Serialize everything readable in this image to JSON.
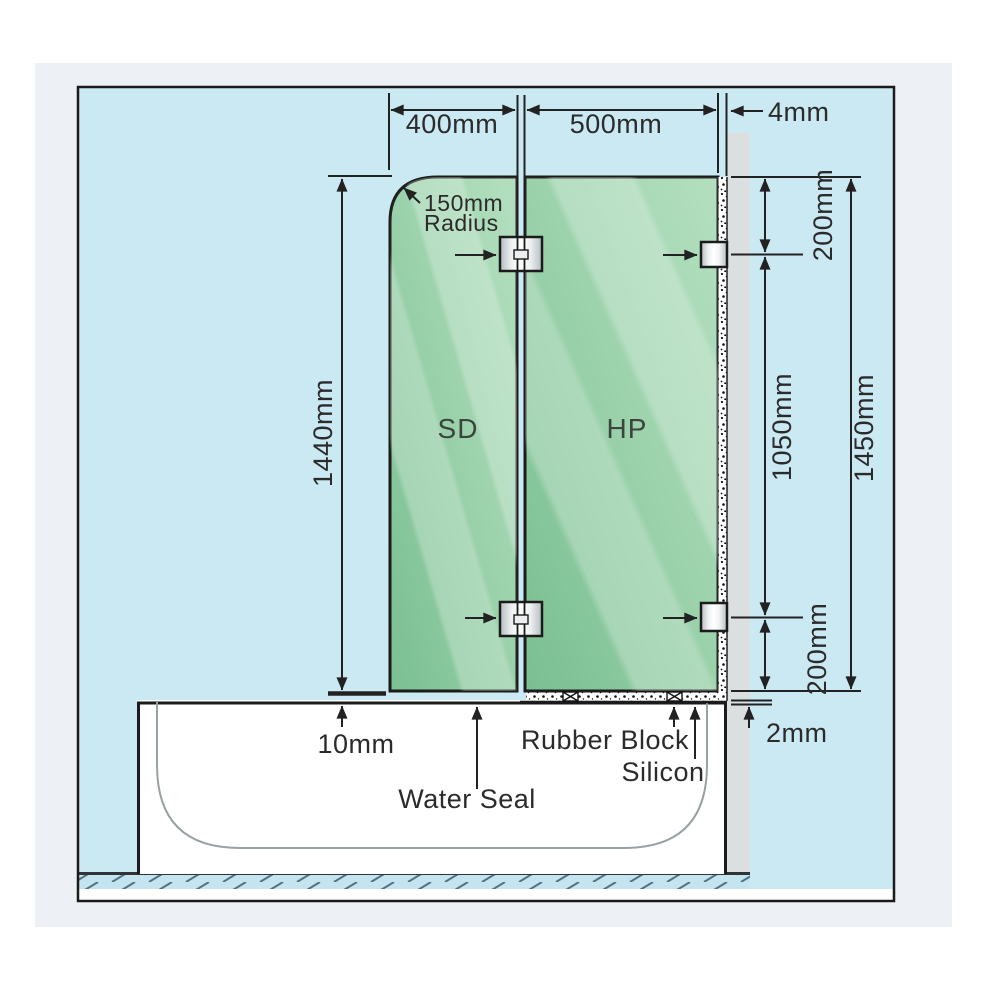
{
  "diagram": {
    "dims": {
      "sd_width": "400mm",
      "hp_width": "500mm",
      "wall_gap": "4mm",
      "radius_value": "150mm",
      "radius_word": "Radius",
      "sd_height": "1440mm",
      "top_bracket_offset": "200mm",
      "bracket_span": "1050mm",
      "hp_height": "1450mm",
      "bottom_bracket_offset": "200mm",
      "tub_gap": "2mm",
      "sd_bottom_gap": "10mm"
    },
    "labels": {
      "sd_panel": "SD",
      "hp_panel": "HP",
      "water_seal": "Water Seal",
      "rubber_block": "Rubber Block",
      "silicon": "Silicon"
    },
    "colors": {
      "frame_bg": "#edf0f4",
      "canvas_bg": "#cbe9f3",
      "wall": "#dcdfe0",
      "glass_dark": "#7abf92",
      "glass_light": "#aeddbb",
      "outline": "#1b1b1b",
      "dim": "#222222"
    }
  }
}
